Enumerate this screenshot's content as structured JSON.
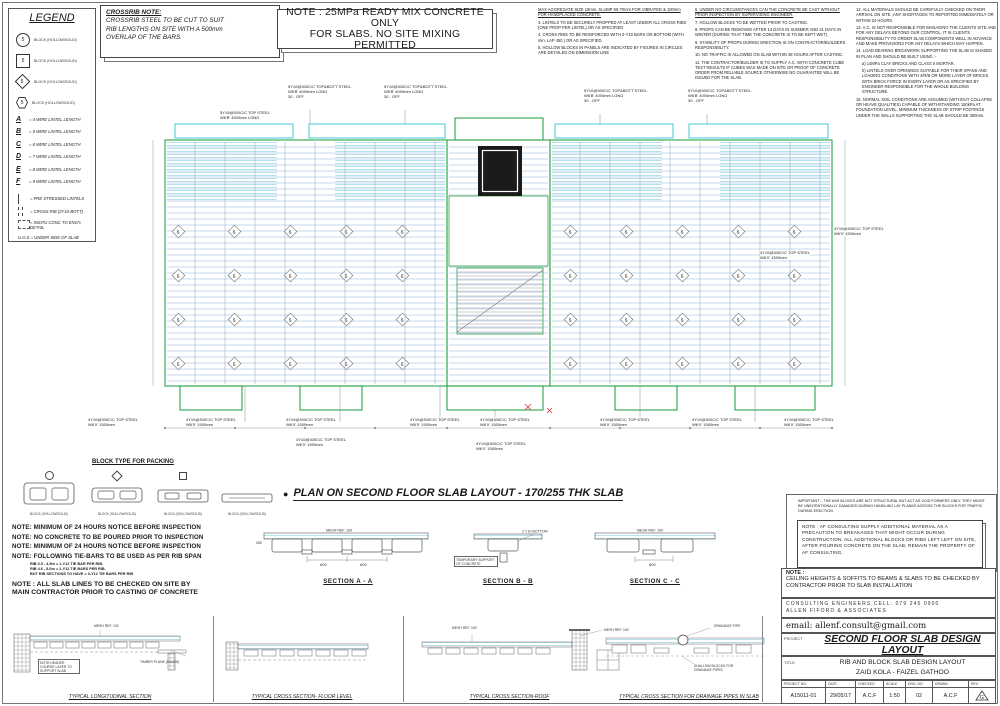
{
  "legend": {
    "title": "LEGEND",
    "block_rows": [
      {
        "num": "5",
        "label": "BLOCK  (HOLLOW/SOLID)"
      },
      {
        "num": "5",
        "label": "BLOCK  (HOLLOW/SOLID)"
      },
      {
        "num": "5",
        "label": "BLOCK  (HOLLOW/SOLID)"
      },
      {
        "num": "5",
        "label": "BLOCK  (HOLLOW/SOLID)"
      }
    ],
    "lintel_rows": [
      {
        "key": "A",
        "label": "= 4 WIRE LINTEL LENGTH"
      },
      {
        "key": "B",
        "label": "= 5 WIRE LINTEL LENGTH"
      },
      {
        "key": "C",
        "label": "= 6 WIRE LINTEL LENGTH"
      },
      {
        "key": "D",
        "label": "= 7 WIRE LINTEL LENGTH"
      },
      {
        "key": "E",
        "label": "= 8 WIRE LINTEL LENGTH"
      },
      {
        "key": "F",
        "label": "= 9 WIRE LINTEL LENGTH"
      }
    ],
    "line_rows": [
      {
        "label": "= PRE STRESSED LINTELS"
      },
      {
        "label": "= CROSS RIB (2Y10-BOTT)"
      },
      {
        "label": "= INSITU CONC TO ENG's DETAIL"
      },
      {
        "label": "U.O.S  = UNDER SIDE OF SLAB"
      }
    ]
  },
  "crossrib": {
    "title": "CROSSRIB NOTE:",
    "l1": "CROSSRIB STEEL TO BE CUT TO SUIT",
    "l2": "RIB LENGTHS ON SITE WITH A 500mm",
    "l3": "OVERLAP OF THE BARS."
  },
  "main_note": {
    "line1": "NOTE : 25MPa READY MIX CONCRETE ONLY",
    "line2": "FOR SLABS. NO SITE MIXING PERMITTED"
  },
  "notes1": {
    "header": "MAX AGGREGATE SIZE 19mm, SLUMP 50-70mm FOR VIBRATED & 100mm FOR HANDPLACED CONCRETE.",
    "items": [
      "3.  LINTELS TO BE SECURELY PROPPED AT LEAST UNDER ALL CROSS RIBS (ONE PROP PER LINTEL) OR AS SPECIFIED",
      "4.  CROSS RIBS TO BE REINFORCED WITH 2-Y10 BARS ON BOTTOM (WITH min. LAP 450 ) OR AS SPECIFIED.",
      "5.  HOLLOW BLOCKS IN PANELS ARE INDICATED BY FIGURES IN CIRCLES ARE DETAILED ON DIMENSION LINE"
    ]
  },
  "notes2": {
    "items": [
      "6.  UNDER NO CIRCUMSTANCES CAN THE CONCRETE BE CAST WITHOUT PRIOR INSPECTION BY SUPERVISING ENGINEER.",
      "7.  HOLLOW BLOCKS TO BE WETTED PRIOR TO CASTING.",
      "8.  PROPS CAN BE REMOVED AFTER 14 DAYS IN SUMMER AND 21 DAYS IN WINTER (DURING THAT TIME THE CONCRETE IS TO BE KEPT WET).",
      "9.  STABILITY OF PROPS DURING ERECTION IS ON CONTRACTOR/BUILDERS RESPONSIBILITY.",
      "10. NO TRAFFIC IS ALLOWED ON SLAB WITHIN 48 HOURS AFTER CASTING.",
      "11. THE CONTRACTOR/BUILDER IS TO SUPPLY A.C. WITH CONCRETE CUBE TEST RESULTS IF CUBES WAS MADE ON SITE OR PROOF OF CONCRETE ORDER FROM RELIABLE SOURCE OTHERWISE NO GUARANTEE WILL BE ISSUED FOR THE SLAB."
    ]
  },
  "notes3": {
    "items": [
      "12. ALL MATERIALS SHOULD BE CAREFULLY CHECKED ON THEIR ARRIVAL ON SITE ,ANY SHORTAGES TO REPORTED IMMEDIATELY OR WITHIN 24 HOURS.",
      "13. A.C. IS NOT RESPONSIBLE FOR MANAGING THE CLIENTS SITE AND FOR ANY DELAYS BEYOND OUR CONTROL. IT IS CLIENTS RESPONSIBILITY TO ORDER SLAB COMPONENTS WELL IN ADVANCE AND MAKE PROVISIONS FOR ANY DELAYS WHICH MAY HAPPEN.",
      "14. LOAD BEARING BRICKWORK SUPPORTING THE SLAB IS SHADED IN PLAN AND SHOULD BE BUILT USING :-",
      "a) 14MPa CLAY BRICKS AND CLASS II MORTAR.",
      "b) LINTELS OVER OPENINGS SUITABLE FOR THEIR SPANS AND LOADING CONDITIONS WITH 4/R/B OR MORE LAYER OF BRICKS WITH BRICK FORCE IN EVERY LAYER OR AS SPECIFIED BY ENGINEER RESPONSIBLE FOR THE WHOLE BUILDING STRUCTURE.",
      "15. NORMAL SOIL CONDITIONS ARE ASSUMED (WITHOUT COLLAPSE OR HEAVE QUALITIES) CAPABLE OF WITHSTANDING 150kPa AT FOUNDATION LEVEL. MINIMUM THICKNESS OF STRIP FOOTINGS UNDER THE WALLS SUPPORTING THE SLAB SHOULD BE 300mm."
    ]
  },
  "plan": {
    "title": "PLAN ON SECOND FLOOR SLAB LAYOUT - 170/255 THK SLAB",
    "top_l1": "5Y10@300C/C TOP&BOTT STEEL",
    "top_l2": "W6'B' 4000mm LONG",
    "top_l3": "30 - OFF",
    "left_l1": "5Y10@300C/C TOP STEEL",
    "left_l2": "W6'B' 4500mm LONG",
    "edge_l1": "4Y10@300C/C TOP STEEL",
    "edge_l2": "W6'X' 1500mm",
    "diamond_count": "6"
  },
  "packing": {
    "title": "BLOCK TYPE FOR PACKING",
    "label": "BLOCK  (HOLLOW/SOLID)"
  },
  "site_notes": [
    "NOTE: MINIMUM OF 24 HOURS NOTICE BEFORE INSPECTION",
    "NOTE: NO CONCRETE TO BE POURED PRIOR TO INSPECTION",
    "NOTE: MINIMUM OF 24 HOURS NOTICE BEFORE INSPECTION",
    "NOTE: FOLLOWING TIE-BARS TO BE USED AS PER RIB SPAN"
  ],
  "tie_bars": [
    "RIB 0.0 - 4.5m            =   1-Y12 TIE BAR  PER RIB.",
    "RIB 4.6 - 8.0m            =   2-Y12 TIE BARS PER RIB.",
    "BUT RIB SECTIONS TO HAVE  =   3-Y12 TIE BARS PER RIB"
  ],
  "slab_note": {
    "l1": "NOTE : ALL SLAB LINES TO BE CHECKED ON SITE BY",
    "l2": "MAIN CONTRACTOR PRIOR TO CASTING OF CONCRETE"
  },
  "sections": {
    "a": {
      "title": "SECTION A - A",
      "mesh": "MESH REF. 100",
      "dim1": "600",
      "dim2": "600",
      "h": "255"
    },
    "b": {
      "title": "SECTION B - B",
      "bott": "2 Y10 BOTTOM",
      "supp": "TEMPORARY SUPPORT OF CONCRETE"
    },
    "c": {
      "title": "SECTION C - C",
      "mesh": "MESH REF. 100",
      "dim1": "600"
    }
  },
  "important": {
    "text": "IMPORTANT :- THE ASH BLOCKS ARE NOT STRUCTURAL BUT ACT AS VOID FORMERS ONLY. THEY MIGHT BE UNINTENTIONALLY DAMAGED DURING HANDLING LAY PLANKS ACROSS THE BLOCKS FOR TRAFFIC DURING ERECTION."
  },
  "af_note": {
    "text": "NOTE : AF CONSULTING SUPPLY ADDITIONAL MATERIAL AS A PRECAUTION TO BREAKAGES THAT MIGHT OCCUR DURING CONSTRUCTION. ALL ADDITIONAL BLOCKS OR RIBS LEFT LEFT ON SITE, AFTER POURING CONCRETE ON THE SLAB, REMAIN THE PROPERTY OF AF CONSULTING."
  },
  "ceiling": {
    "label": "NOTE :",
    "text": "CEILING HEIGHTS & SOFFITS TO BEAMS & SLABS TO BE CHECKED BY CONTRACTOR PRIOR TO SLAB INSTALLATION"
  },
  "eng": {
    "line1": "CONSULTING  ENGINEERS   CELL: 079 245 0900",
    "line2": "ALLEN  FIFORD  &  ASSOCIATES",
    "email": "email: allenf.consult@gmail.com"
  },
  "details": {
    "d1": {
      "title": "TYPICAL LONGITUDINAL SECTION",
      "mesh": "MESH REF. 100",
      "note": "NOTE:HEADER COURSE LAYER TO SUPPORT SLAB",
      "plank": "TIMBER PLANK (50x228)"
    },
    "d2": {
      "title": "TYPICAL CROSS SECTION- FLOOR LEVEL"
    },
    "d3": {
      "title": "TYPICAL CROSS SECTION-ROOF",
      "mesh": "MESH REF. 100"
    },
    "d4": {
      "title": "TYPICAL CROSS SECTION FOR DRAINAGE PIPES IN SLAB",
      "mesh": "MESH REF. 100",
      "pipe": "DRAINAGE PIPE",
      "blocks": "SHALLOW BLOCKS FOR DRAINAGE PIPES"
    }
  },
  "tb": {
    "project_label": "PROJECT",
    "project": "SECOND FLOOR SLAB DESIGN LAYOUT",
    "title_label": "TITLE",
    "title1": "RIB AND BLOCK SLAB DESIGN LAYOUT",
    "title2": "ZAID KOLA - FAIZEL GATHOO",
    "cols": [
      "PROJECT  NO.",
      "DATE",
      "CHECKED",
      "SCALE",
      "DRG. NO.",
      "DRAWN",
      "REV."
    ],
    "vals": [
      "A15011-01",
      "29/05/17",
      "A.C.F",
      "1:50",
      "02",
      "A.C.F",
      "G"
    ]
  }
}
